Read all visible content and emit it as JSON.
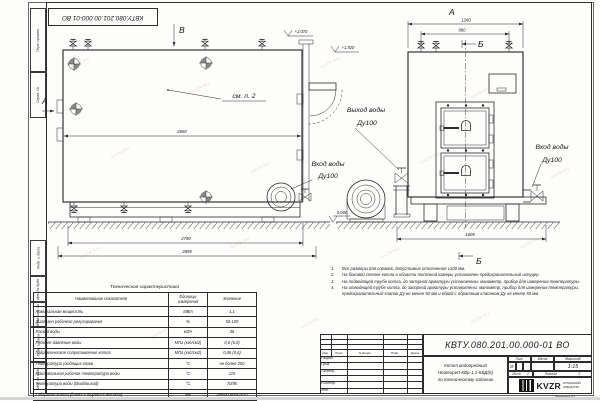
{
  "frame": {
    "stamp_top": "КВТУ.080.201.00.000-01 ВО",
    "margin_labels": [
      "Перв. примен.",
      "Справ. №",
      "Подп. и дата",
      "Инв. № дубл.",
      "Взам. инв. №",
      "Подп. и дата",
      "Инв. № подл."
    ],
    "format_note": "Формат  А3"
  },
  "watermark": "KVZR.RU",
  "drawing": {
    "view_b_label": "В",
    "section_a_label": "А",
    "callout_see_p2": "см. п. 2",
    "elev_top": "+2,070",
    "elev_mid": "+1,920",
    "elev_zero": "0.000",
    "dim_2650": "2650",
    "dim_2790": "2790",
    "dim_2895": "2895",
    "outlet_line1": "Выход воды",
    "outlet_line2": "Ду100",
    "inlet_line1": "Вход воды",
    "inlet_line2": "Ду100",
    "front_a_label": "А",
    "front_b_label": "Б",
    "dim_1260": "1260",
    "dim_960": "960",
    "dim_1605": "1605",
    "inlet2_line1": "Вход воды",
    "inlet2_line2": "Ду100",
    "section_b_bottom": "Б"
  },
  "table": {
    "title": "Техническая характеристика",
    "col1": "Наименование показателя",
    "col2a": "Единицы",
    "col2b": "измерения",
    "col3": "Значение",
    "rows": [
      [
        "Номинальная мощность",
        "МВт",
        "1,1"
      ],
      [
        "Диапазон рабочего регулирования",
        "%",
        "50-100"
      ],
      [
        "Расход воды",
        "м3/ч",
        "38"
      ],
      [
        "Рабочее давление воды",
        "МПа (кгс/см2)",
        "0,6 (6,0)"
      ],
      [
        "Гидравлическое сопротивление котла",
        "МПа (кгс/см2)",
        "0,06 (0,6)"
      ],
      [
        "Температура уходящих газов",
        "°С",
        "не более 250"
      ],
      [
        "Максимальная рабочая температура воды",
        "°С",
        "115"
      ],
      [
        "Температура воды (Вход/выход)",
        "°С",
        "70/95"
      ],
      [
        "Габариты котла (длина х ширина х высота)",
        "мм",
        "2895х1605х2070"
      ]
    ]
  },
  "notes": [
    {
      "n": "1.",
      "t": "Все размеры для справок, допустимые отклонения ±100 мм."
    },
    {
      "n": "2.",
      "t": "На боковой стенке котла в области топочной камеры установлен предохранительный штуцер."
    },
    {
      "n": "3.",
      "t": "На  подводящей  трубе котла, до запорной арматуры установлены:  манометр,  прибор для измерения температуры."
    },
    {
      "n": "4.",
      "t": "На отводящей трубе котла, до запорной арматуры установлены: манометр, прибор для измерения температуры, предохранительный клапан  Ду не менее 50 мм и обвод с обратным клапаном  Ду не менее 50 мм."
    }
  ],
  "titleblock": {
    "doc_number": "КВТУ.080.201.00.000-01  ВО",
    "name1": "Котел водогрейный",
    "name2": "Heatexpert-КВр-1,1-КБД(К)",
    "name3": "по техническому заданию",
    "h_izm": "Изм.",
    "h_list": "Лист",
    "h_dokum": "N докум.",
    "h_podp": "Подп.",
    "h_data": "Дата",
    "r1": "Разраб.",
    "r2": "Пров.",
    "r3": "Т.контр.",
    "r4": "",
    "r5": "Н.контр.",
    "r6": "Утв.",
    "lit_label": "Лит.",
    "mass_label": "Масса",
    "scale_label": "Масштаб",
    "lit_value": "И",
    "scale_value": "1:15",
    "sheet_label": "Лист",
    "sheet_value": "1",
    "sheets_label": "Листов",
    "sheets_value": "2",
    "logo_text": "KVZR",
    "logo_sub1": "КОТЕЛЬНЫЙ",
    "logo_sub2": "ЗАВОД РЭП"
  }
}
